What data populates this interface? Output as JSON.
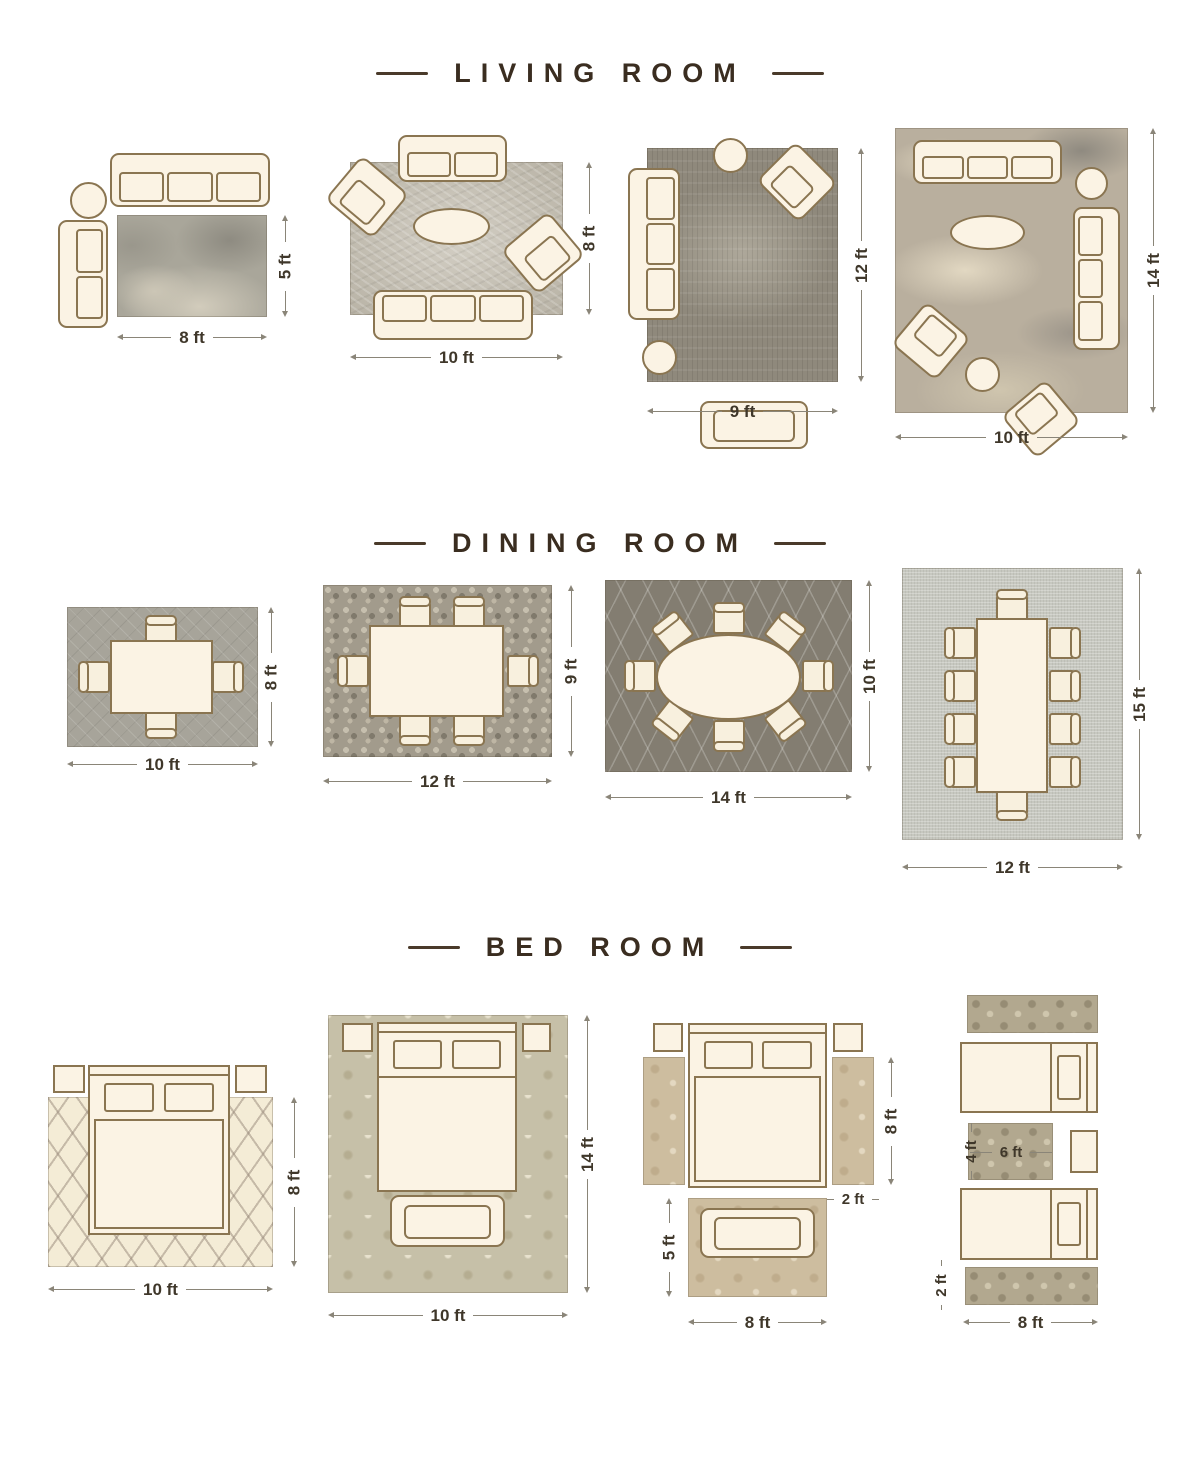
{
  "page": {
    "background": "#ffffff"
  },
  "colors": {
    "title_brown": "#3a2d20",
    "furniture_outline": "#8a7551",
    "furniture_cream": "#fbf3e4",
    "dimension_text": "#3f372a"
  },
  "sections": [
    {
      "title": "LIVING ROOM",
      "layouts": [
        {
          "width_label": "8 ft",
          "height_label": "5 ft"
        },
        {
          "width_label": "10 ft",
          "height_label": "8 ft"
        },
        {
          "width_label": "9 ft",
          "height_label": "12 ft"
        },
        {
          "width_label": "10 ft",
          "height_label": "14 ft"
        }
      ]
    },
    {
      "title": "DINING ROOM",
      "layouts": [
        {
          "width_label": "10 ft",
          "height_label": "8 ft"
        },
        {
          "width_label": "12 ft",
          "height_label": "9 ft"
        },
        {
          "width_label": "14 ft",
          "height_label": "10 ft"
        },
        {
          "width_label": "12 ft",
          "height_label": "15 ft"
        }
      ]
    },
    {
      "title": "BED ROOM",
      "layouts": [
        {
          "width_label": "10 ft",
          "height_label": "8 ft"
        },
        {
          "width_label": "10 ft",
          "height_label": "14 ft"
        },
        {
          "width_label": "8 ft",
          "height_label": "5 ft",
          "runner_length_label": "8 ft",
          "runner_width_label": "2 ft"
        },
        {
          "width_label": "8 ft",
          "runner_width_label": "2 ft",
          "accent_rug_width_label": "6 ft",
          "accent_rug_height_label": "4 ft"
        }
      ]
    }
  ]
}
